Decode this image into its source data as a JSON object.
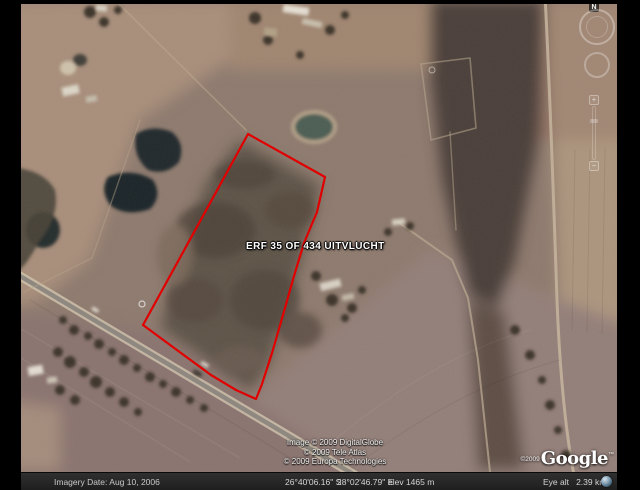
{
  "window": {
    "title": "Google Earth imagery view",
    "width": 640,
    "height": 490
  },
  "placemark": {
    "label": "ERF 35 OF 434 UITVLUCHT",
    "pushpin_color": "#ffe33e"
  },
  "boundary": {
    "color": "#e10000",
    "description": "red property boundary polygon"
  },
  "attribution": {
    "lines": [
      "Image © 2009 DigitalGlobe",
      "© 2009 Tele Atlas",
      "© 2009 Europa Technologies"
    ],
    "watermark_year": "©2009",
    "watermark_logo": "Google",
    "watermark_tm": "™"
  },
  "navigation": {
    "north": "N",
    "zoom_in": "+",
    "zoom_out": "−"
  },
  "status_bar": {
    "imagery_date": "Imagery Date: Aug 10, 2006",
    "latitude": "26°40'06.16\" S",
    "longitude": "28°02'46.79\" E",
    "elevation": "elev 1465 m",
    "eye_altitude": "Eye alt   2.39 km"
  },
  "colors": {
    "boundary_red": "#e10000",
    "status_bar_bg": "#262626",
    "terrain_base": "#8f7b6f"
  }
}
